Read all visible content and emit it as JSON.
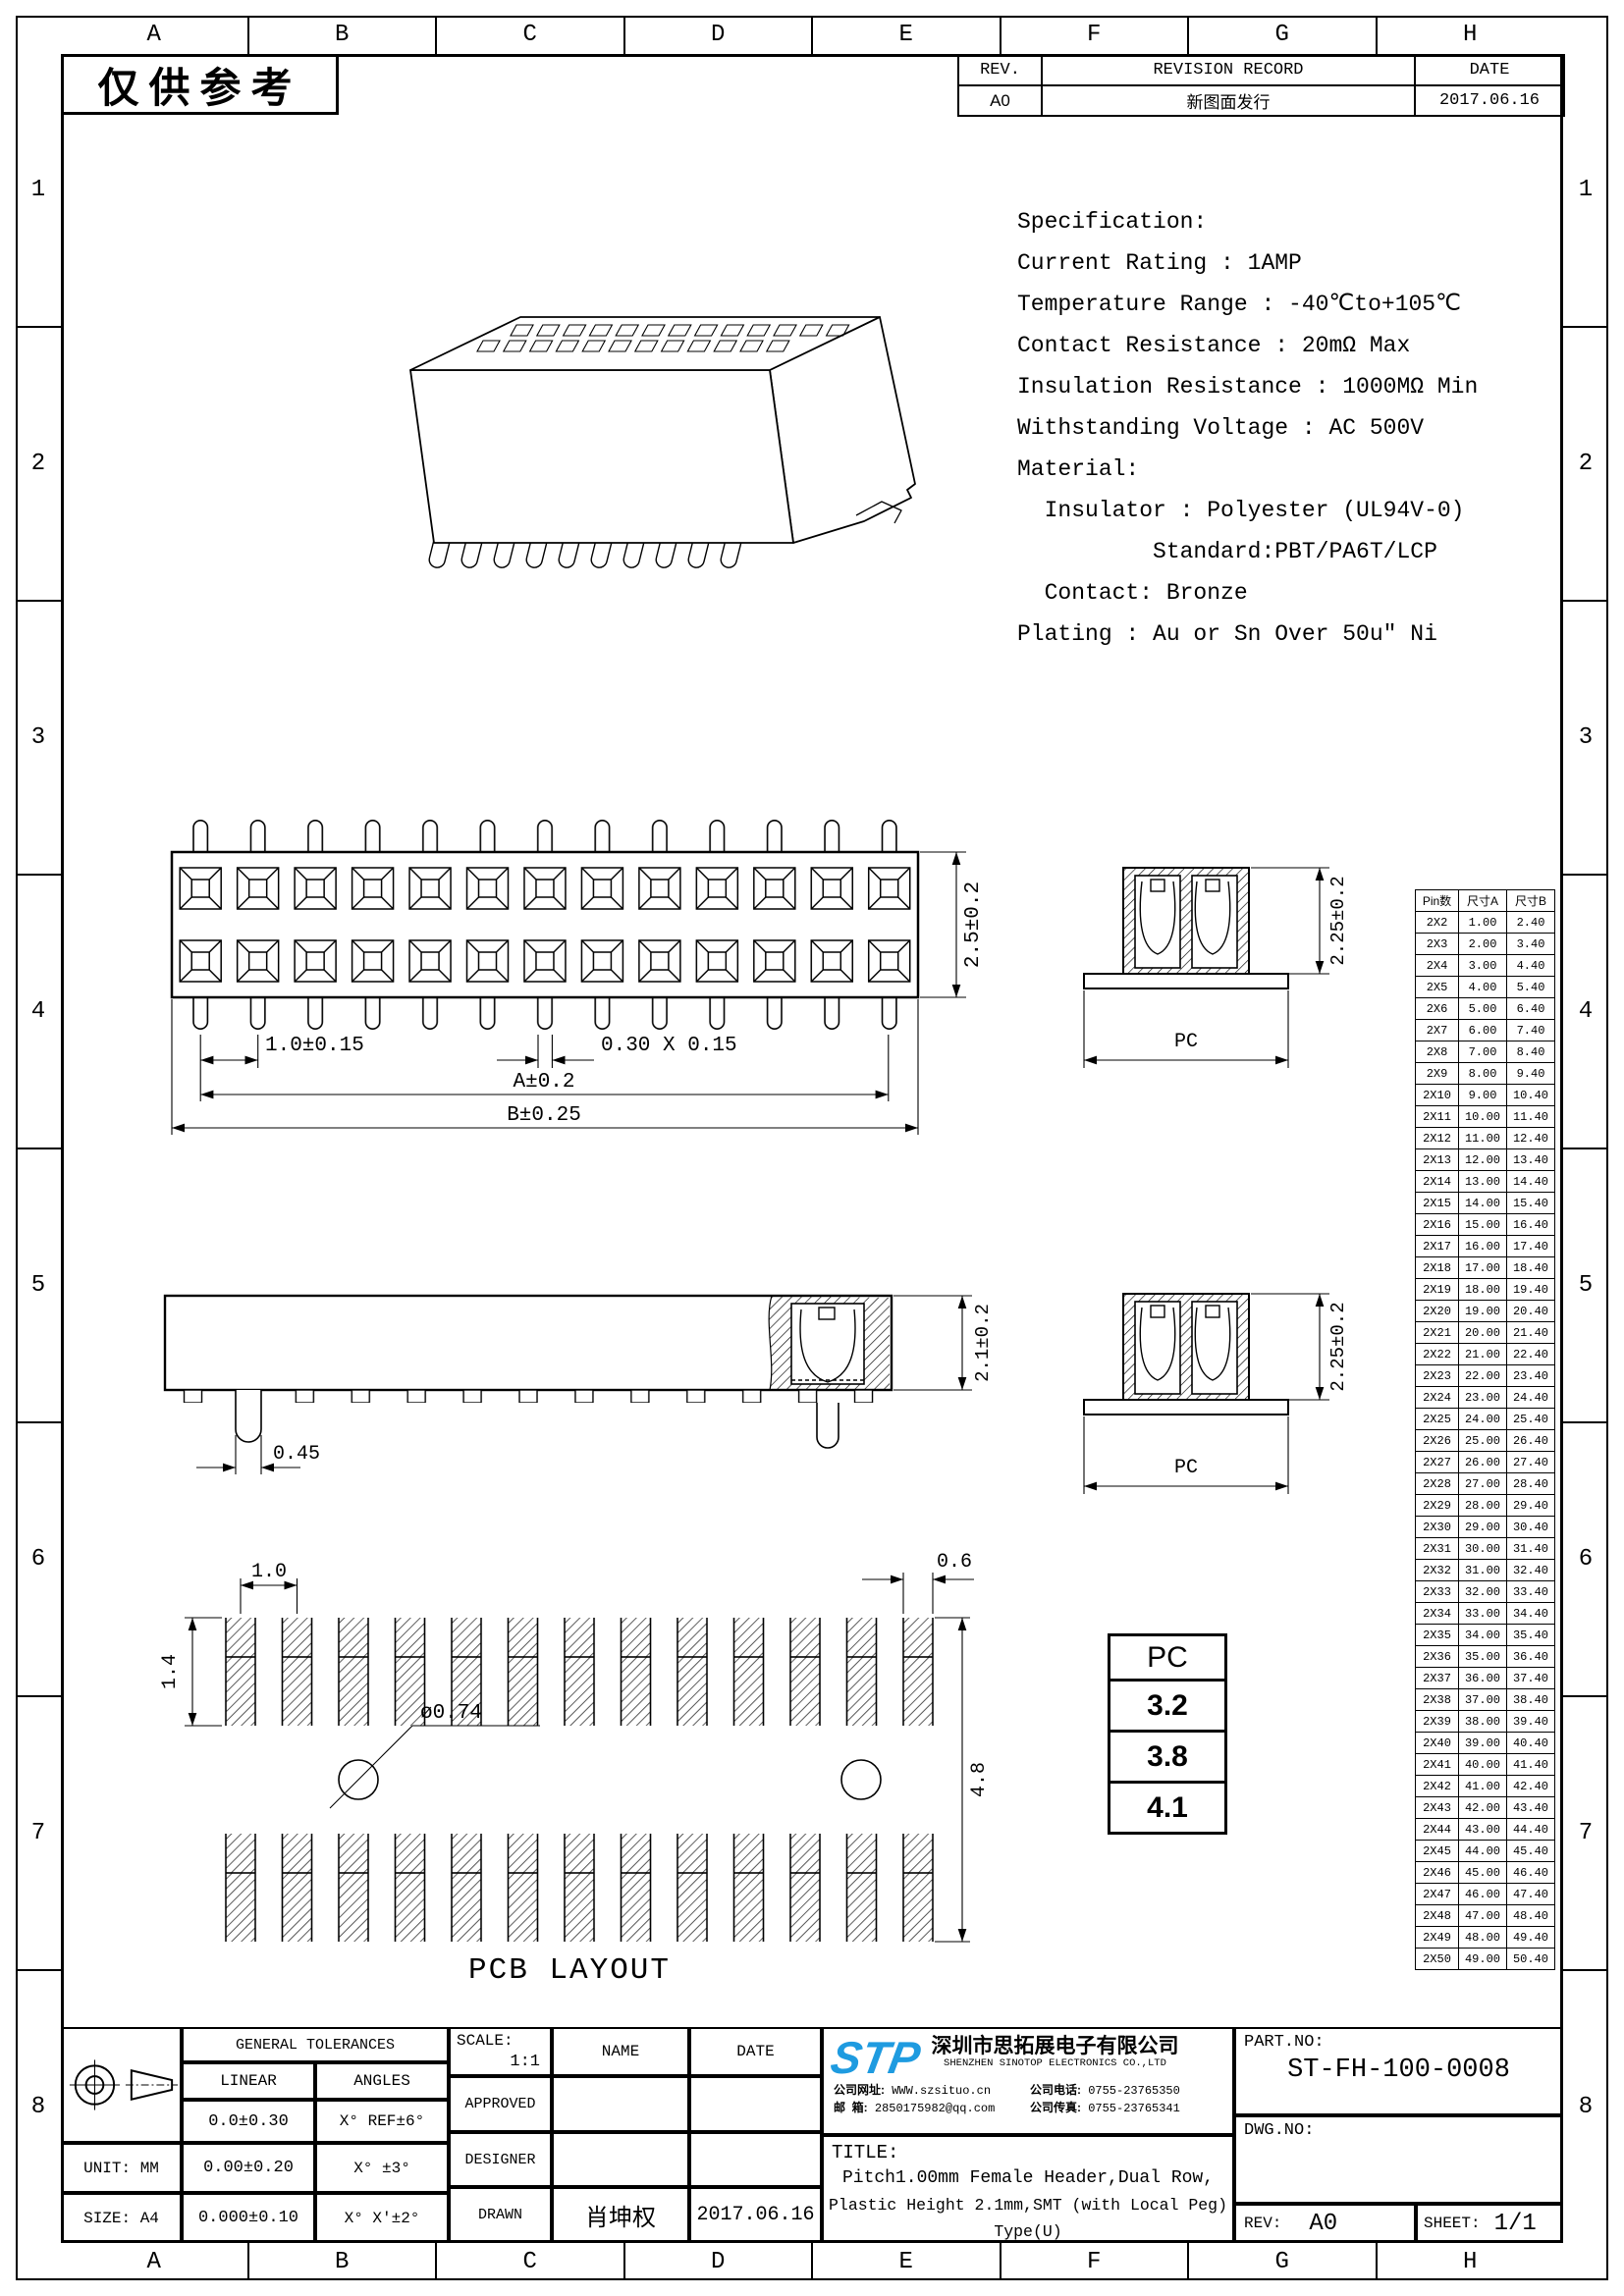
{
  "stamp": "仅供参考",
  "grid": {
    "cols": [
      "A",
      "B",
      "C",
      "D",
      "E",
      "F",
      "G",
      "H"
    ],
    "rows": [
      "1",
      "2",
      "3",
      "4",
      "5",
      "6",
      "7",
      "8"
    ]
  },
  "revision_table": {
    "rev_header": "REV.",
    "record_header": "REVISION RECORD",
    "date_header": "DATE",
    "rows": [
      {
        "rev": "A0",
        "record": "新图面发行",
        "date": "2017.06.16"
      }
    ]
  },
  "specification": {
    "lines": [
      "Specification:",
      "Current Rating : 1AMP",
      "Temperature Range : -40℃to+105℃",
      "Contact Resistance : 20mΩ Max",
      "Insulation Resistance : 1000MΩ Min",
      "Withstanding Voltage : AC 500V",
      "Material:",
      "  Insulator : Polyester (UL94V-0)",
      "          Standard:PBT/PA6T/LCP",
      "  Contact: Bronze",
      "Plating : Au or Sn Over 50u″ Ni"
    ]
  },
  "front_view": {
    "dim_height": "2.5±0.2",
    "dim_pitch": "1.0±0.15",
    "dim_pin": "0.30 X 0.15",
    "dim_a": "A±0.2",
    "dim_b": "B±0.25"
  },
  "side_view_top": {
    "dim_height": "2.25±0.2",
    "dim_width": "PC"
  },
  "section_view": {
    "dim_height": "2.1±0.2",
    "dim_peg": "0.45"
  },
  "side_view_bottom": {
    "dim_height": "2.25±0.2",
    "dim_width": "PC"
  },
  "pcb_layout": {
    "title": "PCB LAYOUT",
    "dim_pitch": "1.0",
    "dim_pad_h": "1.4",
    "dim_pad_w": "0.6",
    "dim_hole": "ø0.74",
    "dim_span": "4.8"
  },
  "pc_table": {
    "header": "PC",
    "values": [
      "3.2",
      "3.8",
      "4.1"
    ]
  },
  "pin_table": {
    "h_pins": "Pin数",
    "h_a": "尺寸A",
    "h_b": "尺寸B",
    "rows": [
      {
        "p": "2X2",
        "a": "1.00",
        "b": "2.40"
      },
      {
        "p": "2X3",
        "a": "2.00",
        "b": "3.40"
      },
      {
        "p": "2X4",
        "a": "3.00",
        "b": "4.40"
      },
      {
        "p": "2X5",
        "a": "4.00",
        "b": "5.40"
      },
      {
        "p": "2X6",
        "a": "5.00",
        "b": "6.40"
      },
      {
        "p": "2X7",
        "a": "6.00",
        "b": "7.40"
      },
      {
        "p": "2X8",
        "a": "7.00",
        "b": "8.40"
      },
      {
        "p": "2X9",
        "a": "8.00",
        "b": "9.40"
      },
      {
        "p": "2X10",
        "a": "9.00",
        "b": "10.40"
      },
      {
        "p": "2X11",
        "a": "10.00",
        "b": "11.40"
      },
      {
        "p": "2X12",
        "a": "11.00",
        "b": "12.40"
      },
      {
        "p": "2X13",
        "a": "12.00",
        "b": "13.40"
      },
      {
        "p": "2X14",
        "a": "13.00",
        "b": "14.40"
      },
      {
        "p": "2X15",
        "a": "14.00",
        "b": "15.40"
      },
      {
        "p": "2X16",
        "a": "15.00",
        "b": "16.40"
      },
      {
        "p": "2X17",
        "a": "16.00",
        "b": "17.40"
      },
      {
        "p": "2X18",
        "a": "17.00",
        "b": "18.40"
      },
      {
        "p": "2X19",
        "a": "18.00",
        "b": "19.40"
      },
      {
        "p": "2X20",
        "a": "19.00",
        "b": "20.40"
      },
      {
        "p": "2X21",
        "a": "20.00",
        "b": "21.40"
      },
      {
        "p": "2X22",
        "a": "21.00",
        "b": "22.40"
      },
      {
        "p": "2X23",
        "a": "22.00",
        "b": "23.40"
      },
      {
        "p": "2X24",
        "a": "23.00",
        "b": "24.40"
      },
      {
        "p": "2X25",
        "a": "24.00",
        "b": "25.40"
      },
      {
        "p": "2X26",
        "a": "25.00",
        "b": "26.40"
      },
      {
        "p": "2X27",
        "a": "26.00",
        "b": "27.40"
      },
      {
        "p": "2X28",
        "a": "27.00",
        "b": "28.40"
      },
      {
        "p": "2X29",
        "a": "28.00",
        "b": "29.40"
      },
      {
        "p": "2X30",
        "a": "29.00",
        "b": "30.40"
      },
      {
        "p": "2X31",
        "a": "30.00",
        "b": "31.40"
      },
      {
        "p": "2X32",
        "a": "31.00",
        "b": "32.40"
      },
      {
        "p": "2X33",
        "a": "32.00",
        "b": "33.40"
      },
      {
        "p": "2X34",
        "a": "33.00",
        "b": "34.40"
      },
      {
        "p": "2X35",
        "a": "34.00",
        "b": "35.40"
      },
      {
        "p": "2X36",
        "a": "35.00",
        "b": "36.40"
      },
      {
        "p": "2X37",
        "a": "36.00",
        "b": "37.40"
      },
      {
        "p": "2X38",
        "a": "37.00",
        "b": "38.40"
      },
      {
        "p": "2X39",
        "a": "38.00",
        "b": "39.40"
      },
      {
        "p": "2X40",
        "a": "39.00",
        "b": "40.40"
      },
      {
        "p": "2X41",
        "a": "40.00",
        "b": "41.40"
      },
      {
        "p": "2X42",
        "a": "41.00",
        "b": "42.40"
      },
      {
        "p": "2X43",
        "a": "42.00",
        "b": "43.40"
      },
      {
        "p": "2X44",
        "a": "43.00",
        "b": "44.40"
      },
      {
        "p": "2X45",
        "a": "44.00",
        "b": "45.40"
      },
      {
        "p": "2X46",
        "a": "45.00",
        "b": "46.40"
      },
      {
        "p": "2X47",
        "a": "46.00",
        "b": "47.40"
      },
      {
        "p": "2X48",
        "a": "47.00",
        "b": "48.40"
      },
      {
        "p": "2X49",
        "a": "48.00",
        "b": "49.40"
      },
      {
        "p": "2X50",
        "a": "49.00",
        "b": "50.40"
      }
    ]
  },
  "title_block": {
    "tolerances": {
      "title": "GENERAL TOLERANCES",
      "col_linear": "LINEAR",
      "col_angles": "ANGLES",
      "lin1": "0.0±0.30",
      "ang1": "X° REF±6°",
      "lin2": "0.00±0.20",
      "ang2": "X° ±3°",
      "lin3": "0.000±0.10",
      "ang3": "X° X'±2°",
      "unit": "UNIT: MM",
      "size": "SIZE: A4"
    },
    "approval": {
      "scale_label": "SCALE:",
      "scale_value": "1:1",
      "name_label": "NAME",
      "date_label": "DATE",
      "approved_label": "APPROVED",
      "designer_label": "DESIGNER",
      "drawn_label": "DRAWN",
      "drawn_name": "肖坤权",
      "drawn_date": "2017.06.16"
    },
    "company": {
      "logo": "STP",
      "name_cn": "深圳市思拓展电子有限公司",
      "name_en": "SHENZHEN SINOTOP ELECTRONICS CO.,LTD",
      "website_label": "公司网址:",
      "website": "WWW.szsituo.cn",
      "email_label": "邮  箱:",
      "email": "2850175982@qq.com",
      "phone_label": "公司电话:",
      "phone": "0755-23765350",
      "fax_label": "公司传真:",
      "fax": "0755-23765341"
    },
    "title": {
      "label": "TITLE:",
      "line1": "Pitch1.00mm Female Header,Dual Row,",
      "line2": "Plastic Height 2.1mm,SMT (with Local Peg) Type(U)"
    },
    "part": {
      "part_no_label": "PART.NO:",
      "part_no": "ST-FH-100-0008",
      "dwg_no_label": "DWG.NO:",
      "rev_label": "REV:",
      "rev": "A0",
      "sheet_label": "SHEET:",
      "sheet": "1/1"
    }
  }
}
